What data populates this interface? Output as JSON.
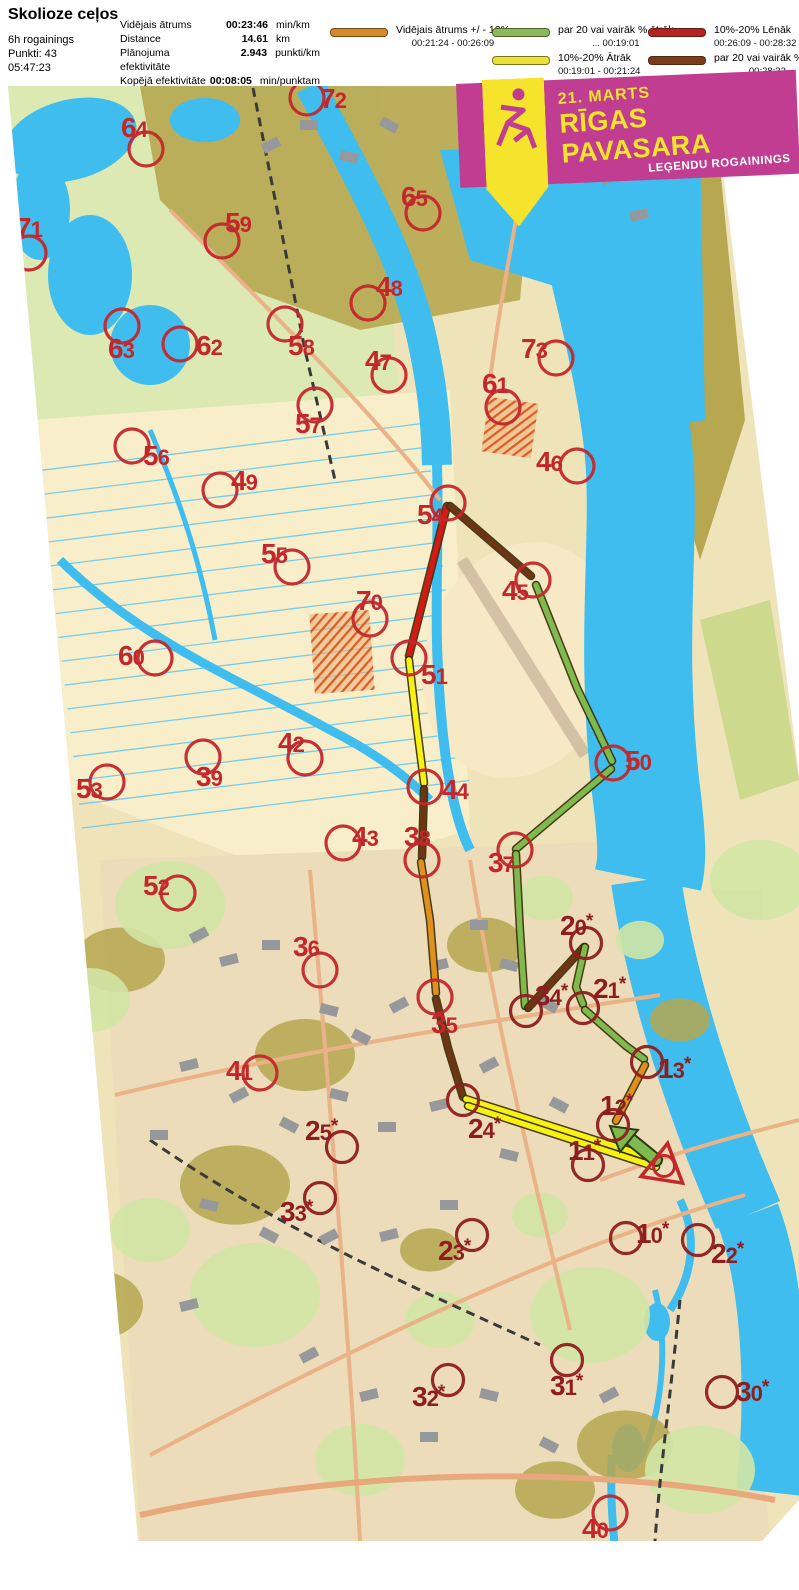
{
  "header": {
    "title": "Skolioze ceļos",
    "meta": [
      "6h rogainings",
      "Punkti: 43",
      "05:47:23"
    ],
    "stats": [
      {
        "label": "Vidējais ātrums",
        "value": "00:23:46",
        "unit": "min/km"
      },
      {
        "label": "Distance",
        "value": "14.61",
        "unit": "km"
      },
      {
        "label": "Plānojuma efektivitāte",
        "value": "2.943",
        "unit": "punkti/km"
      },
      {
        "label": "Kopējā efektivitāte",
        "value": "00:08:05",
        "unit": "min/punktam"
      }
    ]
  },
  "legend": {
    "items": [
      {
        "label": "Vidējais ātrums +/ - 10%",
        "range": "00:21:24   -   00:26:09",
        "color": "#d5892c"
      },
      {
        "label": "par 20 vai vairāk % ātrāk",
        "range": "...   00:19:01",
        "color": "#8cb95e"
      },
      {
        "label": "10%-20% Ātrāk",
        "range": "00:19:01   -   00:21:24",
        "color": "#e8e23a"
      },
      {
        "label": "10%-20% Lēnāk",
        "range": "00:26:09   -   00:28:32",
        "color": "#b42421"
      },
      {
        "label": "par 20 vai vairāk % lēnāk",
        "range": "00:28:32   ...",
        "color": "#7c3c1c"
      }
    ]
  },
  "banner": {
    "date": "21. MARTS",
    "title": "RĪGAS PAVASARA",
    "subtitle": "LEĢENDU ROGAININGS",
    "bg": "#c03d92",
    "accent": "#f6e32b"
  },
  "map": {
    "route_colors": {
      "avg": "#e0901c",
      "fast20": "#7fba4e",
      "fast10": "#f8f213",
      "slow10": "#d31a15",
      "slow20": "#6f3413"
    },
    "control_color": "#c3272b",
    "starred_color": "#8f1d1f",
    "legs": [
      {
        "color": "slow10",
        "points": [
          [
            447,
            506
          ],
          [
            409,
            656
          ]
        ]
      },
      {
        "color": "fast10",
        "points": [
          [
            409,
            660
          ],
          [
            416,
            720
          ],
          [
            424,
            783
          ]
        ]
      },
      {
        "color": "slow20",
        "points": [
          [
            424,
            789
          ],
          [
            422,
            857
          ]
        ]
      },
      {
        "color": "avg",
        "points": [
          [
            421,
            862
          ],
          [
            430,
            920
          ],
          [
            436,
            993
          ]
        ]
      },
      {
        "color": "slow20",
        "points": [
          [
            436,
            999
          ],
          [
            448,
            1048
          ],
          [
            463,
            1097
          ]
        ]
      },
      {
        "color": "fast10",
        "points": [
          [
            466,
            1099
          ],
          [
            652,
            1158
          ]
        ]
      },
      {
        "color": "fast10",
        "points": [
          [
            468,
            1106
          ],
          [
            656,
            1167
          ]
        ]
      },
      {
        "color": "slow20",
        "points": [
          [
            450,
            506
          ],
          [
            531,
            576
          ]
        ]
      },
      {
        "color": "fast20",
        "points": [
          [
            536,
            585
          ],
          [
            577,
            688
          ],
          [
            612,
            761
          ]
        ]
      },
      {
        "color": "fast20",
        "points": [
          [
            611,
            769
          ],
          [
            516,
            849
          ]
        ]
      },
      {
        "color": "fast20",
        "points": [
          [
            516,
            854
          ],
          [
            520,
            930
          ],
          [
            525,
            1006
          ]
        ]
      },
      {
        "color": "slow20",
        "points": [
          [
            528,
            1008
          ],
          [
            584,
            947
          ]
        ]
      },
      {
        "color": "fast20",
        "points": [
          [
            585,
            947
          ],
          [
            576,
            987
          ],
          [
            583,
            1004
          ]
        ]
      },
      {
        "color": "fast20",
        "points": [
          [
            585,
            1010
          ],
          [
            626,
            1046
          ],
          [
            644,
            1059
          ]
        ]
      },
      {
        "color": "avg",
        "points": [
          [
            645,
            1065
          ],
          [
            616,
            1121
          ]
        ]
      }
    ],
    "arrow": {
      "shaft": [
        [
          656,
          1160
        ],
        [
          624,
          1134
        ]
      ],
      "head": [
        [
          610,
          1126
        ],
        [
          638,
          1130
        ],
        [
          620,
          1152
        ]
      ],
      "color": "fast20"
    },
    "finish": {
      "x": 664,
      "y": 1166
    },
    "controls": [
      {
        "n": "72",
        "x": 307,
        "y": 98,
        "lx": 320,
        "ly": 108,
        "star": false
      },
      {
        "n": "64",
        "x": 146,
        "y": 149,
        "lx": 121,
        "ly": 137,
        "star": false
      },
      {
        "n": "71",
        "x": 29,
        "y": 253,
        "lx": 16,
        "ly": 237,
        "star": false
      },
      {
        "n": "59",
        "x": 222,
        "y": 241,
        "lx": 225,
        "ly": 232,
        "star": false
      },
      {
        "n": "65",
        "x": 423,
        "y": 213,
        "lx": 401,
        "ly": 206,
        "star": false
      },
      {
        "n": "48",
        "x": 368,
        "y": 303,
        "lx": 376,
        "ly": 296,
        "star": false
      },
      {
        "n": "63",
        "x": 122,
        "y": 326,
        "lx": 108,
        "ly": 358,
        "star": false
      },
      {
        "n": "62",
        "x": 180,
        "y": 344,
        "lx": 196,
        "ly": 355,
        "star": false
      },
      {
        "n": "58",
        "x": 285,
        "y": 324,
        "lx": 288,
        "ly": 355,
        "star": false
      },
      {
        "n": "47",
        "x": 389,
        "y": 375,
        "lx": 365,
        "ly": 370,
        "star": false
      },
      {
        "n": "73",
        "x": 556,
        "y": 358,
        "lx": 521,
        "ly": 358,
        "star": false
      },
      {
        "n": "61",
        "x": 503,
        "y": 407,
        "lx": 482,
        "ly": 393,
        "star": false
      },
      {
        "n": "57",
        "x": 315,
        "y": 405,
        "lx": 295,
        "ly": 433,
        "star": false
      },
      {
        "n": "56",
        "x": 132,
        "y": 446,
        "lx": 143,
        "ly": 465,
        "star": false
      },
      {
        "n": "49",
        "x": 220,
        "y": 490,
        "lx": 231,
        "ly": 490,
        "star": false
      },
      {
        "n": "46",
        "x": 577,
        "y": 466,
        "lx": 536,
        "ly": 471,
        "star": false
      },
      {
        "n": "54",
        "x": 448,
        "y": 503,
        "lx": 417,
        "ly": 524,
        "star": false
      },
      {
        "n": "45",
        "x": 533,
        "y": 580,
        "lx": 502,
        "ly": 600,
        "star": false
      },
      {
        "n": "55",
        "x": 292,
        "y": 567,
        "lx": 261,
        "ly": 563,
        "star": false
      },
      {
        "n": "70",
        "x": 370,
        "y": 619,
        "lx": 356,
        "ly": 610,
        "star": false
      },
      {
        "n": "60",
        "x": 155,
        "y": 658,
        "lx": 118,
        "ly": 665,
        "star": false
      },
      {
        "n": "51",
        "x": 409,
        "y": 658,
        "lx": 421,
        "ly": 684,
        "star": false
      },
      {
        "n": "50",
        "x": 613,
        "y": 763,
        "lx": 625,
        "ly": 770,
        "star": false
      },
      {
        "n": "42",
        "x": 305,
        "y": 758,
        "lx": 278,
        "ly": 752,
        "star": false
      },
      {
        "n": "53",
        "x": 107,
        "y": 782,
        "lx": 76,
        "ly": 798,
        "star": false
      },
      {
        "n": "39",
        "x": 203,
        "y": 757,
        "lx": 196,
        "ly": 786,
        "star": false
      },
      {
        "n": "44",
        "x": 425,
        "y": 787,
        "lx": 442,
        "ly": 799,
        "star": false
      },
      {
        "n": "43",
        "x": 343,
        "y": 843,
        "lx": 352,
        "ly": 846,
        "star": false
      },
      {
        "n": "38",
        "x": 422,
        "y": 860,
        "lx": 404,
        "ly": 846,
        "star": false
      },
      {
        "n": "37",
        "x": 515,
        "y": 850,
        "lx": 488,
        "ly": 872,
        "star": false
      },
      {
        "n": "52",
        "x": 178,
        "y": 893,
        "lx": 143,
        "ly": 895,
        "star": false
      },
      {
        "n": "20",
        "x": 586,
        "y": 943,
        "lx": 560,
        "ly": 935,
        "star": true
      },
      {
        "n": "36",
        "x": 320,
        "y": 970,
        "lx": 293,
        "ly": 956,
        "star": false
      },
      {
        "n": "34",
        "x": 526,
        "y": 1011,
        "lx": 535,
        "ly": 1005,
        "star": true
      },
      {
        "n": "21",
        "x": 583,
        "y": 1008,
        "lx": 593,
        "ly": 998,
        "star": true
      },
      {
        "n": "35",
        "x": 435,
        "y": 997,
        "lx": 431,
        "ly": 1033,
        "star": false
      },
      {
        "n": "13",
        "x": 647,
        "y": 1062,
        "lx": 658,
        "ly": 1078,
        "star": true
      },
      {
        "n": "12",
        "x": 613,
        "y": 1125,
        "lx": 600,
        "ly": 1115,
        "star": true
      },
      {
        "n": "41",
        "x": 260,
        "y": 1073,
        "lx": 226,
        "ly": 1080,
        "star": false
      },
      {
        "n": "24",
        "x": 463,
        "y": 1100,
        "lx": 468,
        "ly": 1138,
        "star": true
      },
      {
        "n": "11",
        "x": 588,
        "y": 1165,
        "lx": 568,
        "ly": 1160,
        "star": true
      },
      {
        "n": "25",
        "x": 342,
        "y": 1147,
        "lx": 305,
        "ly": 1140,
        "star": true
      },
      {
        "n": "33",
        "x": 320,
        "y": 1198,
        "lx": 280,
        "ly": 1221,
        "star": true
      },
      {
        "n": "23",
        "x": 472,
        "y": 1235,
        "lx": 438,
        "ly": 1260,
        "star": true
      },
      {
        "n": "10",
        "x": 626,
        "y": 1238,
        "lx": 636,
        "ly": 1243,
        "star": true
      },
      {
        "n": "22",
        "x": 698,
        "y": 1240,
        "lx": 711,
        "ly": 1263,
        "star": true
      },
      {
        "n": "31",
        "x": 567,
        "y": 1360,
        "lx": 550,
        "ly": 1395,
        "star": true
      },
      {
        "n": "32",
        "x": 448,
        "y": 1380,
        "lx": 412,
        "ly": 1406,
        "star": true
      },
      {
        "n": "30",
        "x": 722,
        "y": 1392,
        "lx": 736,
        "ly": 1401,
        "star": true
      },
      {
        "n": "40",
        "x": 610,
        "y": 1513,
        "lx": 582,
        "ly": 1538,
        "star": false
      }
    ]
  }
}
